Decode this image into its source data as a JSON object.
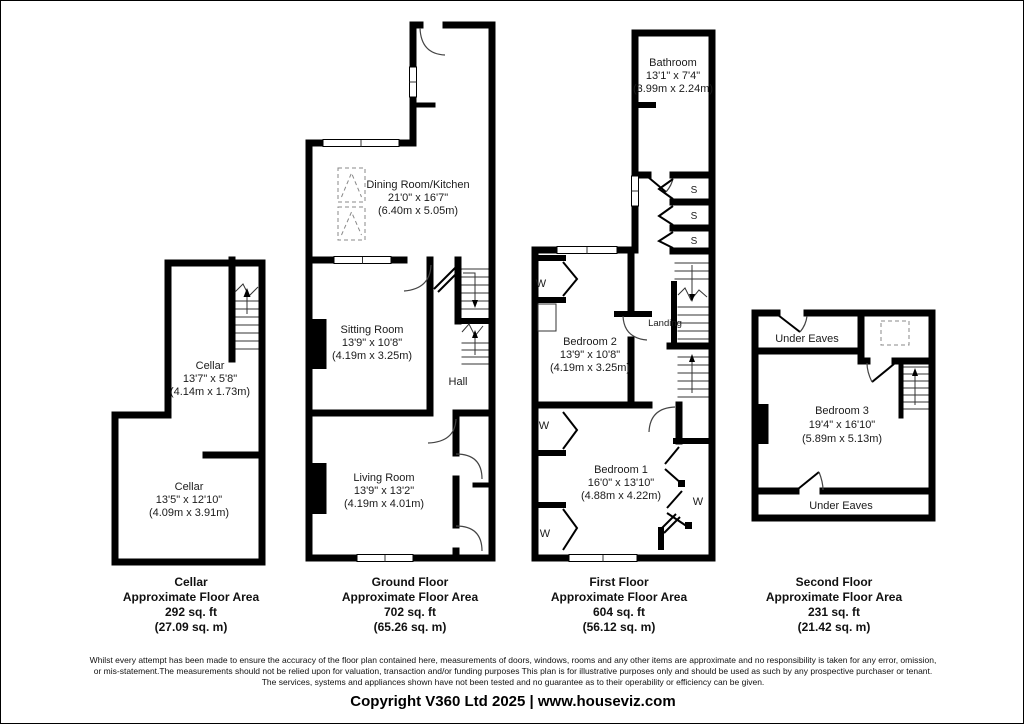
{
  "plans": {
    "cellar": {
      "rooms": [
        {
          "name": "Cellar",
          "imperial": "13'7\" x 5'8\"",
          "metric": "(4.14m x 1.73m)"
        },
        {
          "name": "Cellar",
          "imperial": "13'5\" x 12'10\"",
          "metric": "(4.09m x 3.91m)"
        }
      ]
    },
    "ground": {
      "rooms": [
        {
          "name": "Dining Room/Kitchen",
          "imperial": "21'0\" x 16'7\"",
          "metric": "(6.40m x 5.05m)"
        },
        {
          "name": "Sitting Room",
          "imperial": "13'9\" x 10'8\"",
          "metric": "(4.19m x 3.25m)"
        },
        {
          "name": "Living Room",
          "imperial": "13'9\" x 13'2\"",
          "metric": "(4.19m x 4.01m)"
        }
      ],
      "hall_label": "Hall"
    },
    "first": {
      "rooms": [
        {
          "name": "Bathroom",
          "imperial": "13'1\" x 7'4\"",
          "metric": "(3.99m x 2.24m)"
        },
        {
          "name": "Bedroom 2",
          "imperial": "13'9\" x 10'8\"",
          "metric": "(4.19m x 3.25m)"
        },
        {
          "name": "Bedroom 1",
          "imperial": "16'0\" x 13'10\"",
          "metric": "(4.88m x 4.22m)"
        }
      ],
      "landing_label": "Landing",
      "wardrobe_label": "W",
      "storage_label": "S"
    },
    "second": {
      "rooms": [
        {
          "name": "Bedroom 3",
          "imperial": "19'4\" x 16'10\"",
          "metric": "(5.89m x 5.13m)"
        }
      ],
      "under_eaves_label": "Under Eaves"
    }
  },
  "summaries": [
    {
      "title": "Cellar",
      "subtitle": "Approximate Floor Area",
      "area_ft": "292 sq. ft",
      "area_m": "(27.09 sq. m)"
    },
    {
      "title": "Ground Floor",
      "subtitle": "Approximate Floor Area",
      "area_ft": "702 sq. ft",
      "area_m": "(65.26 sq. m)"
    },
    {
      "title": "First Floor",
      "subtitle": "Approximate Floor Area",
      "area_ft": "604 sq. ft",
      "area_m": "(56.12 sq. m)"
    },
    {
      "title": "Second Floor",
      "subtitle": "Approximate Floor Area",
      "area_ft": "231 sq. ft",
      "area_m": "(21.42 sq. m)"
    }
  ],
  "disclaimer": {
    "lines": [
      "Whilst every attempt has been made to ensure the accuracy of the floor plan contained here, measurements of doors, windows, rooms and any other items are approximate and no responsibility is taken for any error, omission,",
      "or mis-statement.The measurements should not be relied upon for valuation, transaction and/or funding purposes This plan is for illustrative purposes only and should be used as such by any prospective purchaser or tenant.",
      "The services, systems and appliances shown have not been tested and no guarantee as to their operability or efficiency can be given."
    ]
  },
  "copyright": "Copyright V360 Ltd 2025 | www.houseviz.com",
  "colors": {
    "wall": "#000000",
    "background": "#ffffff",
    "thin_line": "#444444",
    "dashed": "#888888"
  }
}
